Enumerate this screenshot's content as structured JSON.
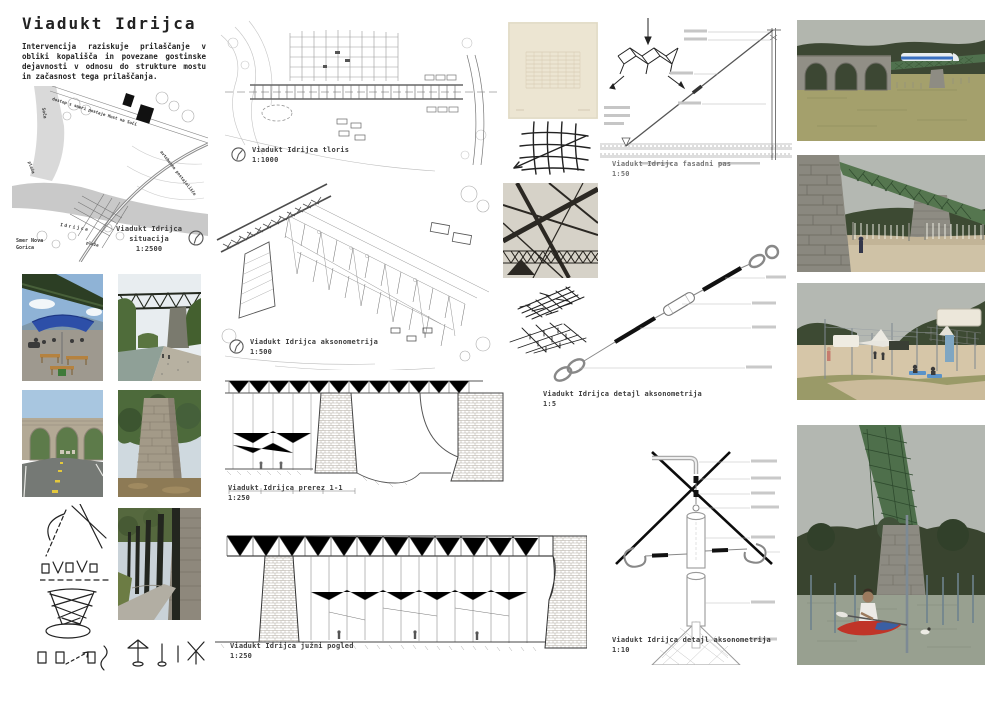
{
  "header": {
    "title": "Viadukt Idrijca",
    "intro": "Intervencija raziskuje prilaščanje v obliki kopališča in povezane gostinske dejavnosti v odnosu do strukture mostu in začasnost tega prilaščanja."
  },
  "site_plan": {
    "caption_line1": "Viadukt Idrijca",
    "caption_line2": "situacija",
    "scale": "1:2500",
    "labels": {
      "access": "dostop s smeri postaje Most na Soči",
      "bus_stop": "avtobusno postajališče",
      "river_side": "Soča",
      "beach_upper": "plaža",
      "beach_lower": "plaža",
      "river_main": "Idrijca",
      "direction_line1": "Smer Nova",
      "direction_line2": "Gorica"
    }
  },
  "captions": {
    "plan": {
      "title": "Viadukt Idrijca tloris",
      "scale": "1:1000"
    },
    "axon": {
      "title": "Viadukt Idrijca aksonometrija",
      "scale": "1:500"
    },
    "section": {
      "title": "Viadukt Idrijca prerez 1-1",
      "scale": "1:250"
    },
    "elevation": {
      "title": "Viadukt Idrijca južni pogled",
      "scale": "1:250"
    },
    "facade": {
      "title": "Viadukt Idrijca fasadni pas",
      "scale": "1:50"
    },
    "detail5": {
      "title": "Viadukt Idrijca detajl aksonometrija",
      "scale": "1:5"
    },
    "detail10": {
      "title": "Viadukt Idrijca detajl aksonometrija",
      "scale": "1:10"
    }
  },
  "colors": {
    "truss_green": "#527150",
    "hill_green": "#3d4a31",
    "meadow": "#a5a26e",
    "sand": "#d7c7a9",
    "water": "#99a192",
    "sky_render": "#b4b8b2",
    "stone": "#8e8c83",
    "kayak_red": "#c03428",
    "umbrella_blue": "#2d4fa8"
  }
}
